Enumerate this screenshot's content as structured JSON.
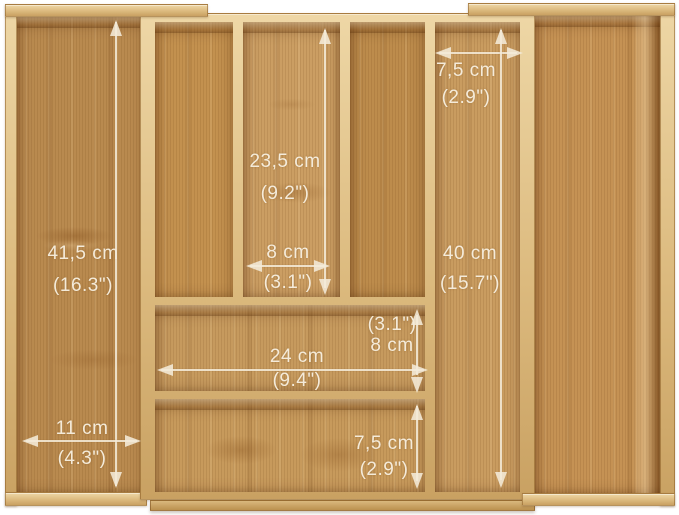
{
  "image": {
    "subject": "Expandable bamboo drawer cutlery organizer with dimension markings",
    "background": "#ffffff"
  },
  "colors": {
    "frame_wood": "#dcba7e",
    "interior_wood": "#c6985c",
    "interior_wood_dark": "#b98a4f",
    "annotation_text": "#f5ecd9"
  },
  "annotations": [
    {
      "id": "height-left-tray",
      "metric": "41,5 cm",
      "imperial": "(16.3\")",
      "orientation": "vertical"
    },
    {
      "id": "depth-top-middle-compartment",
      "metric": "23,5 cm",
      "imperial": "(9.2\")",
      "orientation": "vertical"
    },
    {
      "id": "width-middle-compartment",
      "metric": "8 cm",
      "imperial": "(3.1\")",
      "orientation": "horizontal"
    },
    {
      "id": "width-long-compartment",
      "metric": "7,5 cm",
      "imperial": "(2.9\")",
      "orientation": "horizontal"
    },
    {
      "id": "height-long-compartment",
      "metric": "40 cm",
      "imperial": "(15.7\")",
      "orientation": "vertical"
    },
    {
      "id": "height-wide-compartment",
      "metric": "8 cm",
      "imperial": "(3.1\")",
      "orientation": "vertical"
    },
    {
      "id": "width-wide-compartment",
      "metric": "24 cm",
      "imperial": "(9.4\")",
      "orientation": "horizontal"
    },
    {
      "id": "width-left-tray",
      "metric": "11 cm",
      "imperial": "(4.3\")",
      "orientation": "horizontal"
    },
    {
      "id": "height-bottom-compartment",
      "metric": "7,5 cm",
      "imperial": "(2.9\")",
      "orientation": "vertical"
    }
  ]
}
